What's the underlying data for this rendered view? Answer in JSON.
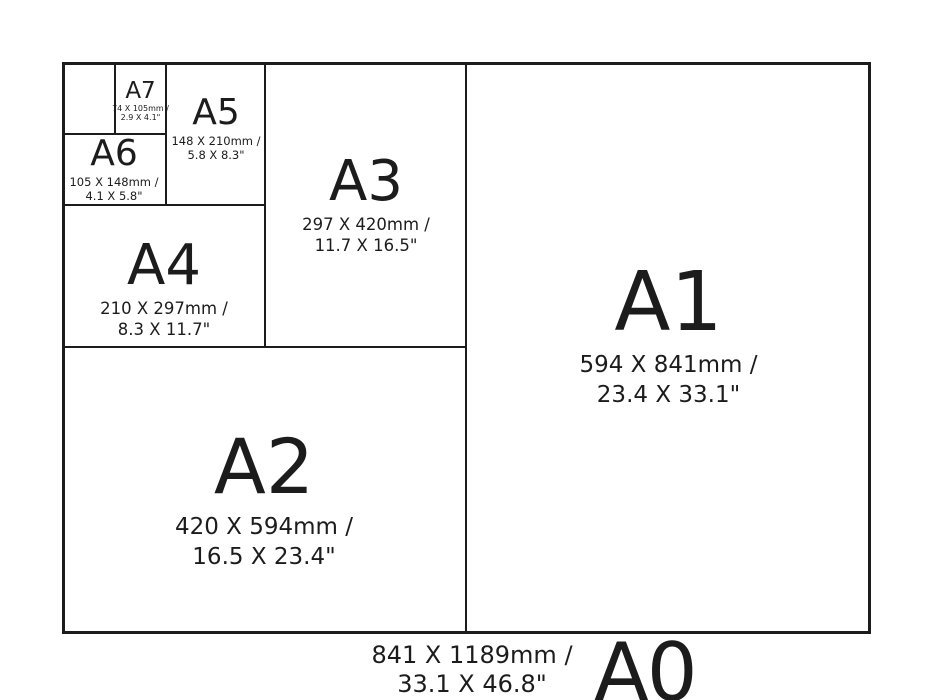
{
  "diagram_title": "A-series paper size comparison",
  "colors": {
    "background": "#ffffff",
    "ink": "#1c1c1c"
  },
  "paper_sizes": {
    "a7": {
      "label": "A7",
      "dims_mm": "74 X 105mm /",
      "dims_in": "2.9 X 4.1\""
    },
    "a6": {
      "label": "A6",
      "dims_mm": "105 X 148mm /",
      "dims_in": "4.1 X 5.8\""
    },
    "a5": {
      "label": "A5",
      "dims_mm": "148 X 210mm /",
      "dims_in": "5.8 X 8.3\""
    },
    "a4": {
      "label": "A4",
      "dims_mm": "210 X 297mm /",
      "dims_in": "8.3 X 11.7\""
    },
    "a3": {
      "label": "A3",
      "dims_mm": "297 X 420mm /",
      "dims_in": "11.7 X 16.5\""
    },
    "a2": {
      "label": "A2",
      "dims_mm": "420 X 594mm /",
      "dims_in": "16.5 X 23.4\""
    },
    "a1": {
      "label": "A1",
      "dims_mm": "594 X 841mm /",
      "dims_in": "23.4 X 33.1\""
    },
    "a0": {
      "label": "A0",
      "dims_mm": "841 X 1189mm /",
      "dims_in": "33.1 X 46.8\""
    }
  }
}
